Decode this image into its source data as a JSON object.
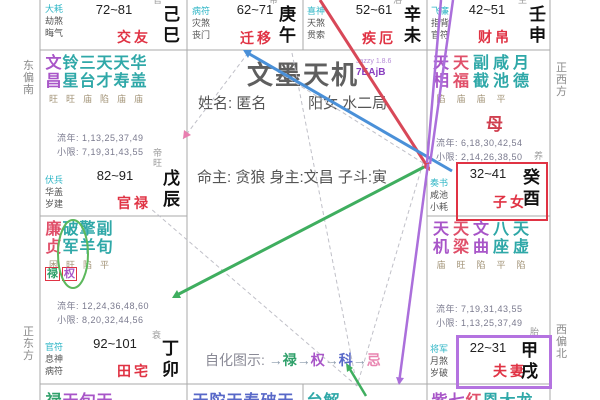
{
  "app": {
    "title": "文墨天机",
    "version_name": "Jazzy 1.8.6",
    "version_code": "7EAjB",
    "person_name": "姓名: 匿名",
    "gender_bureau": "阳女 水二局",
    "masters": "命主: 贪狼 身主:文昌 子斗:寅",
    "mother_marker": "母"
  },
  "legend": {
    "label": "自化图示:",
    "arrow": "→",
    "items": [
      {
        "t": "禄",
        "c": "green"
      },
      {
        "t": "权",
        "c": "purple"
      },
      {
        "t": "科",
        "c": "blue"
      },
      {
        "t": "忌",
        "c": "pink"
      }
    ]
  },
  "compass": {
    "left_top": "东偏南",
    "left_bottom": "正东方",
    "right_top": "正西方",
    "right_bottom": "西偏北"
  },
  "palaces": {
    "si": {
      "branch": "己巳",
      "stage": "官",
      "name": "交友",
      "age": "72~81",
      "gods": [
        {
          "t": "大耗",
          "cyan": true
        },
        {
          "t": "劫煞"
        },
        {
          "t": "晦气"
        }
      ]
    },
    "wu": {
      "branch": "庚午",
      "stage": "带",
      "name": "迁移",
      "age": "62~71",
      "gods": [
        {
          "t": "病符",
          "cyan": true
        },
        {
          "t": "灾煞"
        },
        {
          "t": "丧门"
        }
      ]
    },
    "wei": {
      "branch": "辛未",
      "stage": "浴",
      "name": "疾厄",
      "age": "52~61",
      "gods": [
        {
          "t": "喜神",
          "cyan": true
        },
        {
          "t": "天煞"
        },
        {
          "t": "贯索"
        }
      ]
    },
    "shen": {
      "branch": "壬申",
      "stage": "生",
      "name": "财帛",
      "age": "42~51",
      "gods": [
        {
          "t": "飞廉",
          "cyan": true
        },
        {
          "t": "指背"
        },
        {
          "t": "官符"
        }
      ]
    },
    "you": {
      "branch": "癸酉",
      "stage": "养",
      "name": "子女",
      "age": "32~41",
      "marker": "母",
      "gods": [
        {
          "t": "奏书",
          "cyan": true
        },
        {
          "t": "咸池"
        },
        {
          "t": "小耗"
        }
      ],
      "stars": [
        {
          "name": "天相",
          "st": "陷",
          "c": "purple"
        },
        {
          "name": "天福",
          "st": "庙",
          "c": "red"
        },
        {
          "name": "副截",
          "st": "庙",
          "c": "teal"
        },
        {
          "name": "咸池",
          "st": "平",
          "c": "teal"
        },
        {
          "name": "月德",
          "st": "",
          "c": "teal"
        }
      ],
      "liunian": "流年: 6,18,30,42,54",
      "xiaoxian": "小限: 2,14,26,38,50"
    },
    "xu": {
      "branch": "甲戌",
      "stage": "胎",
      "name": "夫妻",
      "age": "22~31",
      "gods": [
        {
          "t": "将军",
          "cyan": true
        },
        {
          "t": "月煞"
        },
        {
          "t": "岁破"
        }
      ],
      "stars": [
        {
          "name": "天机",
          "st": "庙",
          "c": "purple"
        },
        {
          "name": "天梁",
          "st": "旺",
          "c": "red"
        },
        {
          "name": "文曲",
          "st": "陷",
          "c": "purple"
        },
        {
          "name": "八座",
          "st": "平",
          "c": "teal"
        },
        {
          "name": "天虚",
          "st": "陷",
          "c": "teal"
        }
      ],
      "liunian": "流年: 7,19,31,43,55",
      "xiaoxian": "小限: 1,13,25,37,49"
    },
    "chen": {
      "branch": "戊辰",
      "stage": "帝旺",
      "name": "官禄",
      "age": "82~91",
      "gods": [
        {
          "t": "伏兵",
          "cyan": true
        },
        {
          "t": "华盖"
        },
        {
          "t": "岁建"
        }
      ],
      "stars": [
        {
          "name": "文昌",
          "st": "旺",
          "c": "purple"
        },
        {
          "name": "铃星",
          "st": "旺",
          "c": "teal"
        },
        {
          "name": "三台",
          "st": "庙",
          "c": "teal"
        },
        {
          "name": "天才",
          "st": "陷",
          "c": "teal"
        },
        {
          "name": "天寿",
          "st": "庙",
          "c": "teal"
        },
        {
          "name": "华盖",
          "st": "庙",
          "c": "teal"
        }
      ],
      "liunian": "流年: 1,13,25,37,49",
      "xiaoxian": "小限: 7,19,31,43,55"
    },
    "mao": {
      "branch": "丁卯",
      "stage": "衰",
      "name": "田宅",
      "age": "92~101",
      "gods": [
        {
          "t": "官符",
          "cyan": true
        },
        {
          "t": "息神"
        },
        {
          "t": "病符"
        }
      ],
      "stars": [
        {
          "name": "廉贞",
          "st": "困",
          "c": "red"
        },
        {
          "name": "破军",
          "st": "旺",
          "c": "teal"
        },
        {
          "name": "擎羊",
          "st": "陷",
          "c": "teal"
        },
        {
          "name": "副旬",
          "st": "平",
          "c": "teal"
        }
      ],
      "hua": [
        {
          "t": "禄",
          "c": "green"
        },
        {
          "t": "权",
          "c": "purple"
        }
      ],
      "liunian": "流年: 12,24,36,48,60",
      "xiaoxian": "小限: 8,20,32,44,56"
    },
    "yin": {
      "chars": [
        {
          "t": "禄",
          "c": "green"
        },
        {
          "t": "天",
          "c": "purple"
        },
        {
          "t": "旬",
          "c": "purple"
        },
        {
          "t": "天",
          "c": "purple"
        }
      ]
    },
    "chou": {
      "chars": [
        {
          "t": "天",
          "c": "blue"
        },
        {
          "t": "陀",
          "c": "blue"
        },
        {
          "t": "天",
          "c": "blue"
        },
        {
          "t": "寿",
          "c": "blue"
        },
        {
          "t": "破",
          "c": "blue"
        },
        {
          "t": "天",
          "c": "blue"
        }
      ]
    },
    "zi": {
      "chars": [
        {
          "t": "台",
          "c": "teal"
        },
        {
          "t": "解",
          "c": "teal"
        }
      ]
    },
    "hai": {
      "chars": [
        {
          "t": "紫",
          "c": "purple"
        },
        {
          "t": "七",
          "c": "purple"
        },
        {
          "t": "红",
          "c": "red"
        },
        {
          "t": "恩",
          "c": "teal"
        },
        {
          "t": "大",
          "c": "teal"
        },
        {
          "t": "龙",
          "c": "teal"
        }
      ]
    }
  },
  "colors": {
    "palace_name": "#e03344",
    "highlight_children_box": "#e03344",
    "highlight_spouse_box": "#b473e0",
    "arrow_blue": "#4a90d8",
    "arrow_red": "#d84858",
    "arrow_green": "#3fae5f",
    "arrow_purple": "#ab6fdb",
    "arrow_pink": "#e87fb0",
    "circle_green": "#5cb85c"
  }
}
